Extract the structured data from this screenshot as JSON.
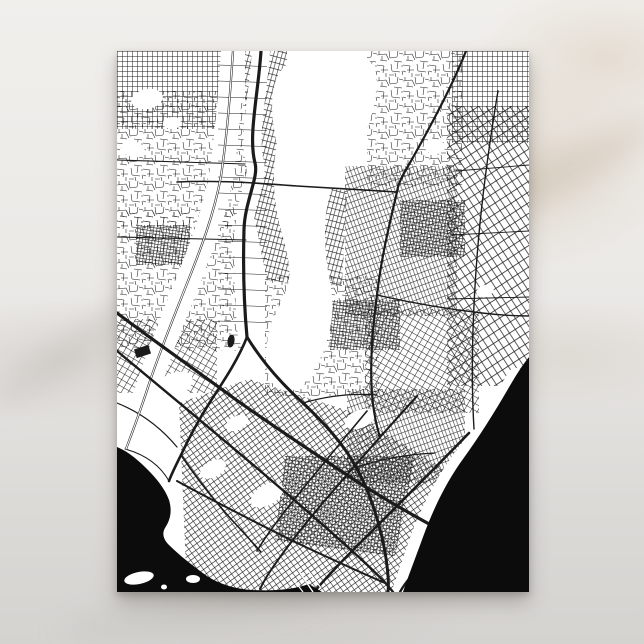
{
  "scene": {
    "surface": "white marble tabletop",
    "product": "postcard with black and white city street map print, portrait orientation",
    "background_top_color": "#F1EFEC",
    "background_bottom_color": "#D5D3D0",
    "vein_warm_color": "#D9CBBA",
    "vein_gray_color": "#C9C5C0",
    "postcard_color": "#FFFFFF",
    "shadow_color": "rgba(88,84,78,0.35)"
  },
  "map": {
    "style": "black ink street network on white, solid black water",
    "ink": "#1B1B1B",
    "water_color": "#0C0C0C",
    "background": "#FFFFFF",
    "districts": [
      {
        "pattern": "pFine0",
        "points": "0,0 108,0 108,78 0,78"
      },
      {
        "pattern": "pChaos",
        "points": "0,40 132,40 132,175 0,175"
      },
      {
        "pattern": "pFine15",
        "points": "128,0 170,0 170,128 128,128"
      },
      {
        "pattern": "pChaos",
        "points": "250,0 345,0 345,135 250,135"
      },
      {
        "pattern": "pFine0",
        "points": "335,0 412,0 412,92 335,92"
      },
      {
        "pattern": "pCoarse",
        "points": "330,55 412,55 412,335 330,335"
      },
      {
        "pattern": "pFineM20",
        "points": "228,115 340,115 340,265 228,265"
      },
      {
        "pattern": "pDense",
        "points": "283,149 348,149 348,206 283,206"
      },
      {
        "pattern": "pChaos",
        "points": "0,160 126,160 126,300 0,300"
      },
      {
        "pattern": "pDense",
        "points": "19,174 73,174 73,214 19,214"
      },
      {
        "pattern": "pFine30",
        "points": "0,268 100,268 100,342 0,342"
      },
      {
        "pattern": "pChaos",
        "points": "148,225 262,225 262,345 148,345"
      },
      {
        "pattern": "pDense",
        "points": "213,249 283,249 283,299 213,299"
      },
      {
        "pattern": "pFine30",
        "points": "248,258 362,258 362,362 248,362"
      },
      {
        "pattern": "pFine15",
        "points": "128,120 230,140 225,235 150,230"
      },
      {
        "pattern": "pFineM20",
        "points": "230,338 348,338 348,432 230,432"
      },
      {
        "pattern": "pDown",
        "points": "62,352 132,328 232,360 334,422 302,541 70,541"
      },
      {
        "pattern": "pDense",
        "points": "168,405 298,405 278,505 158,490"
      }
    ],
    "open_areas": [
      {
        "type": "path",
        "d": "M160,92 C152,60 153,28 169,14 C186,2 216,0 241,4 C257,7 261,22 259,40 C257,62 249,86 237,104 C227,119 217,128 212,146 C207,166 207,190 210,214 C213,232 217,248 215,266 C212,290 203,312 191,328 C181,341 167,344 157,334 C149,325 147,306 151,286 C155,268 163,254 169,240 C174,228 173,214 169,198 C165,182 160,166 158,148 C156,128 157,108 160,92 Z"
      },
      {
        "type": "ellipse",
        "cx": 30,
        "cy": 48,
        "rx": 16,
        "ry": 10,
        "rot": -10
      },
      {
        "type": "ellipse",
        "cx": 16,
        "cy": 98,
        "rx": 12,
        "ry": 8,
        "rot": 15
      },
      {
        "type": "ellipse",
        "cx": 55,
        "cy": 72,
        "rx": 9,
        "ry": 6,
        "rot": 0
      },
      {
        "type": "ellipse",
        "cx": 318,
        "cy": 96,
        "rx": 10,
        "ry": 7,
        "rot": 0
      },
      {
        "type": "ellipse",
        "cx": 368,
        "cy": 240,
        "rx": 9,
        "ry": 6,
        "rot": -20
      },
      {
        "type": "ellipse",
        "cx": 55,
        "cy": 335,
        "rx": 22,
        "ry": 12,
        "rot": -25
      },
      {
        "type": "ellipse",
        "cx": 96,
        "cy": 418,
        "rx": 14,
        "ry": 8,
        "rot": -28
      },
      {
        "type": "ellipse",
        "cx": 150,
        "cy": 444,
        "rx": 18,
        "ry": 10,
        "rot": -30
      },
      {
        "type": "ellipse",
        "cx": 243,
        "cy": 368,
        "rx": 16,
        "ry": 9,
        "rot": -22
      },
      {
        "type": "ellipse",
        "cx": 120,
        "cy": 372,
        "rx": 12,
        "ry": 7,
        "rot": -25
      },
      {
        "type": "ellipse",
        "cx": 356,
        "cy": 430,
        "rx": 14,
        "ry": 20,
        "rot": 18
      },
      {
        "type": "ellipse",
        "cx": 373,
        "cy": 396,
        "rx": 10,
        "ry": 14,
        "rot": 15
      },
      {
        "type": "ellipse",
        "cx": 390,
        "cy": 352,
        "rx": 8,
        "ry": 12,
        "rot": 12
      }
    ],
    "corridors": [
      {
        "d": "M116,0 C113,45 110,85 104,125 C97,164 83,200 69,235 C56,268 43,300 33,330 C25,355 17,377 9,398",
        "w": 24
      },
      {
        "d": "M144,0 C141,45 131,85 138,112 C142,126 128,150 127,178 C126,214 127,254 130,286",
        "w": 18
      },
      {
        "d": "M399,326 C384,352 366,380 347,404 C329,428 314,456 302,488 C294,512 288,528 284,541",
        "w": 18
      }
    ],
    "ticks": {
      "x1": 101,
      "x2": 150,
      "yStart": 14,
      "yEnd": 274,
      "step": 16,
      "w": 0.55
    },
    "roads": [
      {
        "d": "M0,109 L128,113",
        "w": 1.1
      },
      {
        "d": "M0,186 L129,189",
        "w": 1.1
      },
      {
        "d": "M60,131 C100,129 140,132 180,135 C215,137 250,139 280,141",
        "w": 1.6
      },
      {
        "d": "M260,244 C295,252 330,258 365,262 C382,264 398,265 412,265",
        "w": 1.4
      },
      {
        "d": "M381,40 C371,100 363,160 359,220 C355,278 354,328 357,378",
        "w": 1.4
      },
      {
        "d": "M339,120 L412,114",
        "w": 0.9
      },
      {
        "d": "M334,184 L412,180",
        "w": 0.9
      },
      {
        "d": "M331,248 L412,246",
        "w": 0.9
      },
      {
        "d": "M186,352 C210,345 235,342 260,344",
        "w": 1.2
      },
      {
        "d": "M239,416 C265,408 292,403 318,402",
        "w": 1.2
      },
      {
        "d": "M0,352 C25,362 45,378 60,396",
        "w": 1.2
      },
      {
        "d": "M8,398 C30,404 44,416 52,430",
        "w": 1.0
      },
      {
        "d": "M64,404 C80,428 97,449 114,468 C126,481 136,492 144,501",
        "w": 1.6
      },
      {
        "d": "M116,0 C113,45 110,85 104,125 C97,164 83,200 69,235 C56,268 43,300 33,330 C25,355 17,377 9,398",
        "w": 2.2
      },
      {
        "d": "M116,0 C113,45 110,85 104,125 C97,164 83,200 69,235 C56,268 43,300 33,330 C25,355 17,377 9,398",
        "w": 1.1,
        "color": "#FFFFFF"
      },
      {
        "d": "M349,0 C336,34 312,78 294,110 C285,125 281,133 280,141 C271,179 264,209 260,244 C254,289 252,329 257,360 C259,372 261,380 263,386",
        "w": 2.2
      },
      {
        "d": "M300,345 C272,376 243,408 216,440 C190,470 168,498 152,522 C148,528 145,534 143,538",
        "w": 2.0
      },
      {
        "d": "M404,352 C390,383 374,412 357,440 C340,468 324,497 312,524 L308,541",
        "w": 2.0
      },
      {
        "d": "M250,360 C225,390 200,420 176,450 C160,470 148,486 140,500",
        "w": 1.6
      },
      {
        "d": "M60,430 C100,452 140,472 180,492 C210,506 240,520 268,532",
        "w": 2.0
      },
      {
        "d": "M0,300 C46,338 96,380 141,418 C181,452 216,482 246,510 C259,522 269,532 276,541",
        "w": 2.4
      },
      {
        "d": "M398,424 C369,452 337,482 307,512 C297,522 289,530 283,541",
        "w": 2.4
      },
      {
        "d": "M352,382 C323,412 291,444 259,476 C233,502 213,522 197,541",
        "w": 2.6
      },
      {
        "d": "M130,286 C121,309 106,331 93,351 C81,370 71,389 64,404 C58,416 54,424 52,430",
        "w": 2.6
      },
      {
        "d": "M130,286 C146,312 166,334 186,352 C206,371 226,392 239,416 C253,441 263,473 268,501 C271,519 272,532 271,541",
        "w": 3.0
      },
      {
        "d": "M0,262 C40,292 80,320 118,348 C160,378 200,404 236,428 C272,451 306,470 336,486 C356,496 370,505 379,512",
        "w": 3.2
      },
      {
        "d": "M144,0 C141,45 131,85 138,112 C142,126 128,150 127,178 C126,214 127,254 130,286",
        "w": 3.2
      }
    ],
    "water": [
      {
        "name": "ocean-lower-right",
        "d": "M412,306 C404,316 398,326 391,338 C377,362 362,386 346,408 C330,430 317,456 306,486 C298,508 291,526 286,541 L412,541 Z"
      },
      {
        "name": "bay-lower-left",
        "d": "M0,396 C10,400 20,408 30,418 C40,428 48,438 52,449 C55,459 54,468 48,477 C45,482 46,488 52,494 C62,504 76,515 90,525 C102,533 118,538 135,539 C155,540 175,539 192,533 L205,541 L0,541 Z"
      }
    ],
    "piers": [
      {
        "d": "M183,522 L196,541",
        "w": 1.4
      },
      {
        "d": "M190,518 L204,537",
        "w": 1.2
      },
      {
        "d": "M176,528 L186,541",
        "w": 1.2
      }
    ],
    "islands": [
      {
        "cx": 22,
        "cy": 527,
        "rx": 15,
        "ry": 6,
        "rot": -12
      },
      {
        "cx": 76,
        "cy": 528,
        "rx": 7,
        "ry": 4,
        "rot": 0
      },
      {
        "cx": 47,
        "cy": 536,
        "rx": 3,
        "ry": 2.5,
        "rot": 0
      }
    ],
    "landmarks": [
      {
        "type": "rect",
        "x": 18,
        "y": 296,
        "w": 15,
        "h": 9,
        "rot": -18
      },
      {
        "type": "ellipse",
        "cx": 114,
        "cy": 290,
        "rx": 3.5,
        "ry": 6.5,
        "rot": 10
      }
    ]
  }
}
